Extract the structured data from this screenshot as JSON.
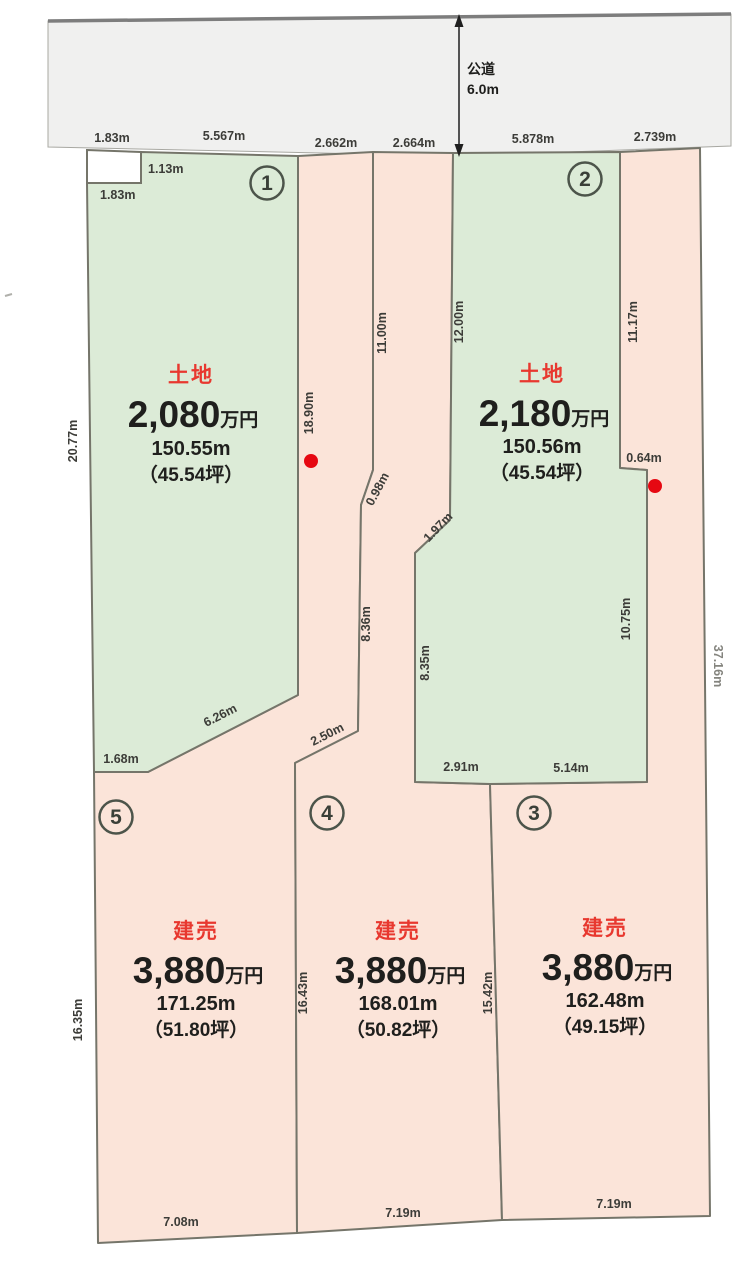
{
  "title": "区画図",
  "colors": {
    "land_green": "#dcebd7",
    "built_pink": "#fbe4d9",
    "road_gray": "#f0f0ef",
    "boundary": "#75756a",
    "accent_red": "#e8382f",
    "dot_red": "#e60812"
  },
  "road": {
    "name": "公道",
    "width": "6.0m"
  },
  "plots": [
    {
      "id": "1",
      "type": "土地",
      "price": "2,080",
      "price_unit": "万円",
      "area": "150.55m",
      "tsubo": "（45.54坪）"
    },
    {
      "id": "2",
      "type": "土地",
      "price": "2,180",
      "price_unit": "万円",
      "area": "150.56m",
      "tsubo": "（45.54坪）"
    },
    {
      "id": "3",
      "type": "建売",
      "price": "3,880",
      "price_unit": "万円",
      "area": "162.48m",
      "tsubo": "（49.15坪）"
    },
    {
      "id": "4",
      "type": "建売",
      "price": "3,880",
      "price_unit": "万円",
      "area": "168.01m",
      "tsubo": "（50.82坪）"
    },
    {
      "id": "5",
      "type": "建売",
      "price": "3,880",
      "price_unit": "万円",
      "area": "171.25m",
      "tsubo": "（51.80坪）"
    }
  ],
  "dims": {
    "notch_top": "1.83m",
    "notch_right": "1.13m",
    "notch_bottom": "1.83m",
    "p1_top": "5.567m",
    "strip5_top": "2.662m",
    "strip4_top": "2.664m",
    "p2_top": "5.878m",
    "strip3_top": "2.739m",
    "p1_left": "20.77m",
    "p1_right": "18.90m",
    "strip5_right_upper": "11.00m",
    "strip5_right_diag": "0.98m",
    "strip5_right_mid": "8.36m",
    "strip5_right_lower_diag": "2.50m",
    "p2_left": "12.00m",
    "p2_left_diag": "1.97m",
    "p2_left_lower": "8.35m",
    "p2_right_upper": "11.17m",
    "p2_step": "0.64m",
    "p2_right_lower": "10.75m",
    "p2_bottom_left": "2.91m",
    "p2_bottom_right": "5.14m",
    "p1_bottom_diag": "6.26m",
    "p1_bottom": "1.68m",
    "outer_right": "37.16m",
    "p5_left": "16.35m",
    "p5_p4_divider": "16.43m",
    "p4_p3_divider": "15.42m",
    "p5_bottom": "7.08m",
    "p4_bottom": "7.19m",
    "p3_bottom": "7.19m"
  }
}
